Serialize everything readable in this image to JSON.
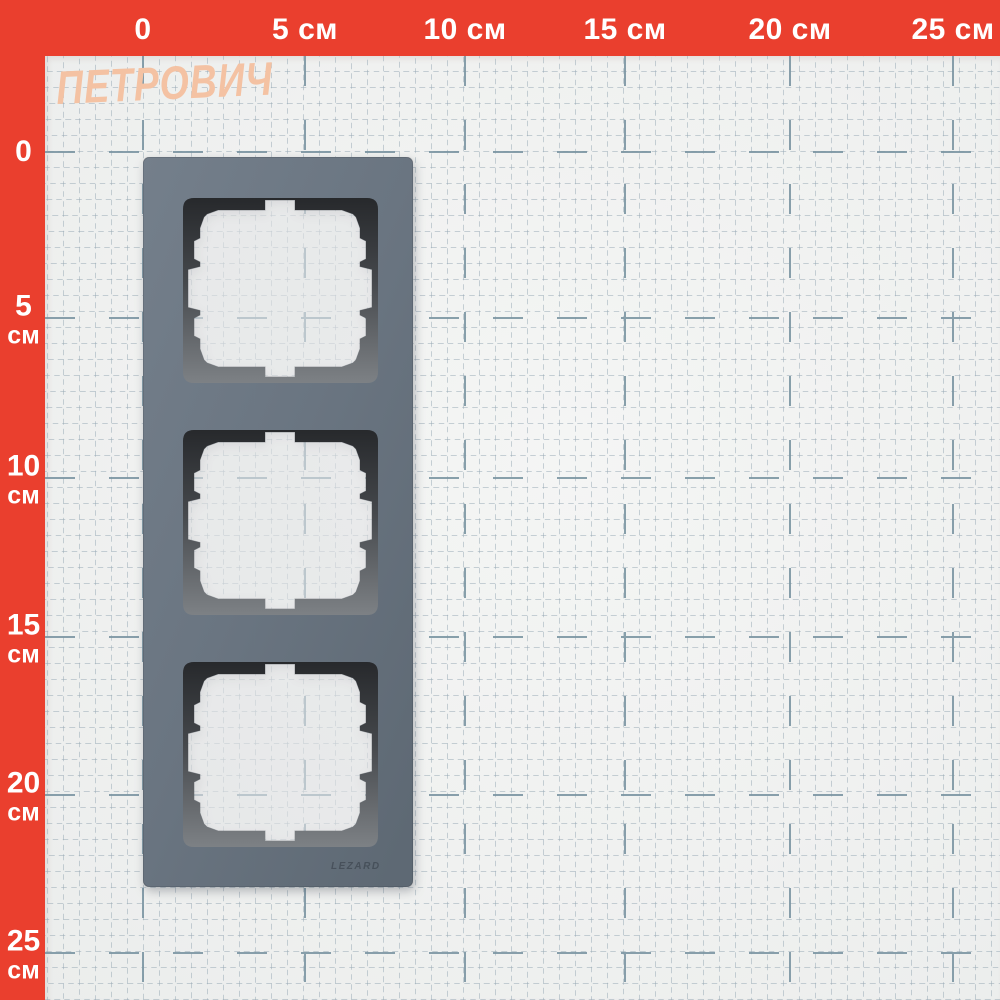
{
  "brand": {
    "logo_text": "ПЕТРОВИЧ"
  },
  "rulers": {
    "unit": "см",
    "top": {
      "labels": [
        "0",
        "5 см",
        "10 см",
        "15 см",
        "20 см",
        "25 см"
      ]
    },
    "left": {
      "labels": [
        {
          "value": "0",
          "unit": ""
        },
        {
          "value": "5",
          "unit": "см"
        },
        {
          "value": "10",
          "unit": "см"
        },
        {
          "value": "15",
          "unit": "см"
        },
        {
          "value": "20",
          "unit": "см"
        },
        {
          "value": "25",
          "unit": "см"
        }
      ]
    }
  },
  "product": {
    "embossed_brand": "LEZARD"
  },
  "colors": {
    "ruler_red": "#ea3f2e",
    "paper_white": "#f1f2f1",
    "grid_fine": "#96a8b4",
    "grid_major": "#7c96a3",
    "frame_grey": "#6a7581",
    "bevel_dark": "#27292c",
    "logo_peach": "#f4c2a3"
  }
}
